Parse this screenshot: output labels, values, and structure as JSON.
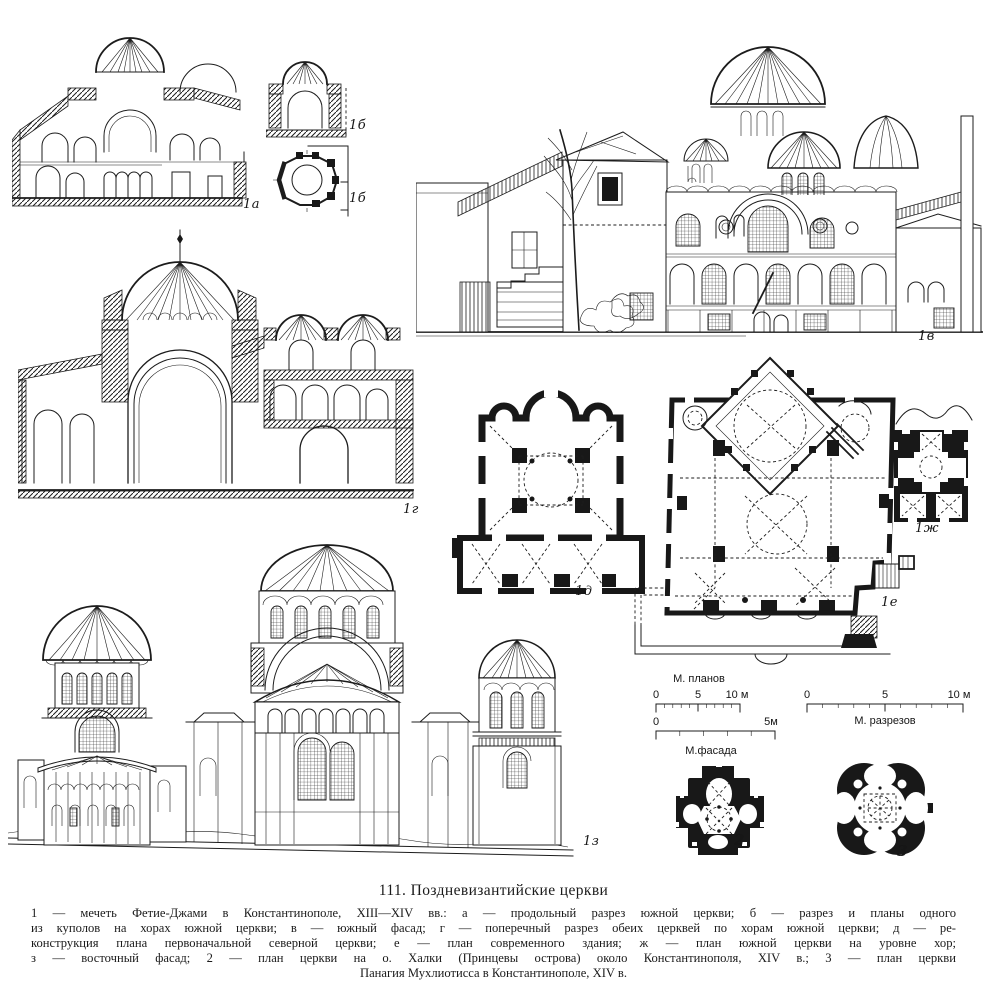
{
  "colors": {
    "paper": "#ffffff",
    "ink": "#1c1c1c"
  },
  "figures": {
    "a": {
      "label": "1а"
    },
    "b1": {
      "label": "1б"
    },
    "b2": {
      "label": "1б"
    },
    "v": {
      "label": "1в"
    },
    "g": {
      "label": "1г"
    },
    "d": {
      "label": "1д"
    },
    "e": {
      "label": "1е"
    },
    "zh": {
      "label": "1ж"
    },
    "z": {
      "label": "1з"
    },
    "n2": {
      "label": "2"
    },
    "n3": {
      "label": "3"
    }
  },
  "scalebars": {
    "plans": {
      "title": "М. планов",
      "t0": "0",
      "t5": "5",
      "t10": "10 м"
    },
    "facade": {
      "title": "М.фасада",
      "t0": "0",
      "t5": "5м"
    },
    "sections": {
      "title": "М. разрезов",
      "t0": "0",
      "t5": "5",
      "t10": "10 м"
    }
  },
  "caption": {
    "title": "111. Поздневизантийские церкви",
    "lines": [
      "1 — мечеть Фетие-Джами в Константинополе, XIII—XIV вв.: а — продольный разрез южной церкви; б — разрез и планы одного",
      "из куполов на хорах южной церкви; в — южный фасад; г — поперечный разрез обеих церквей по хорам южной церкви; д — ре-",
      "конструкция плана первоначальной северной церкви; е — план современного здания; ж — план южной церкви на уровне хор;",
      "з — восточный фасад; 2 — план церкви на о. Халки (Принцевы острова) около Константинополя, XIV в.; 3 — план церкви",
      "Панагия Мухлиотисса в Константинополе, XIV в."
    ]
  }
}
